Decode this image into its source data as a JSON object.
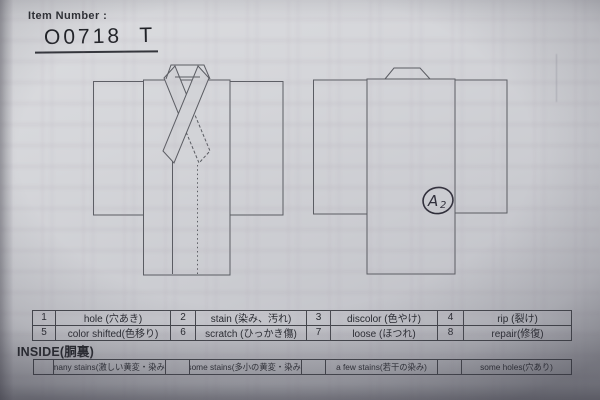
{
  "header": {
    "item_number_label": "Item Number :",
    "item_number_value": "O0718  T"
  },
  "annotation": {
    "letter": "A",
    "subscript": "2"
  },
  "defects_table": {
    "rows": [
      [
        "1",
        "hole (穴あき)",
        "2",
        "stain (染み、汚れ)",
        "3",
        "discolor (色やけ)",
        "4",
        "rip (裂け)"
      ],
      [
        "5",
        "color shifted(色移り)",
        "6",
        "scratch (ひっかき傷)",
        "7",
        "loose (ほつれ)",
        "8",
        "repair(修復)"
      ]
    ]
  },
  "inside_section": {
    "title": "INSIDE(胴裏)",
    "cells": [
      "",
      "many stains(激しい黄変・染み)",
      "",
      "some stains(多小の黄変・染み)",
      "",
      "a few stains(若干の染み)",
      "",
      "some holes(穴あり)"
    ]
  },
  "colors": {
    "paper": "#cfd0d5",
    "diagram_line": "#5a5c62",
    "ink": "#23252b",
    "annotation_ink": "#2f2e3a"
  }
}
